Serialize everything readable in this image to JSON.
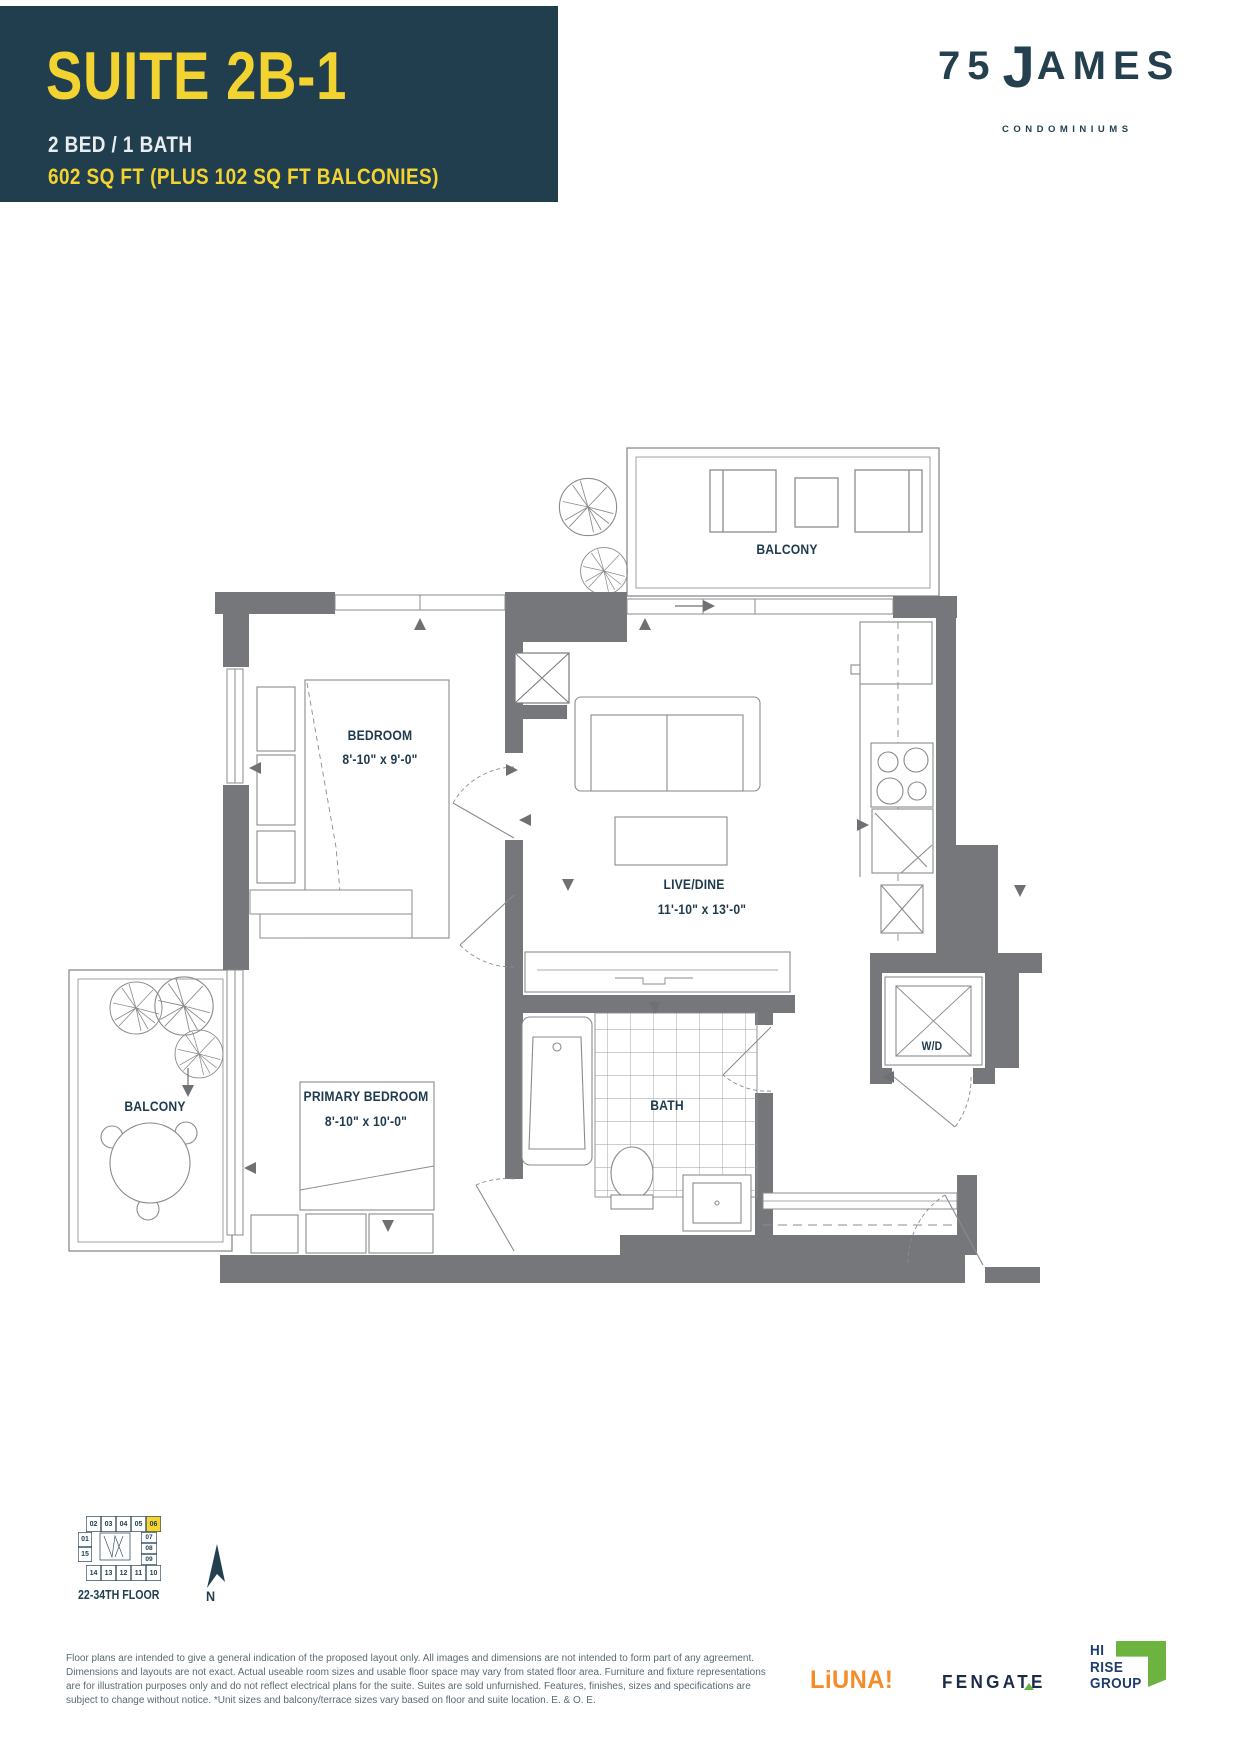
{
  "colors": {
    "header_bg": "#213e4e",
    "accent_yellow": "#f3d32f",
    "navy_text": "#1e3a4c",
    "wall_gray": "#76777a",
    "line_gray": "#8a8b8e",
    "keyplan_highlight": "#f5d42c",
    "liuna_orange": "#f68b28",
    "fengate_navy": "#1c2b49",
    "logo_green": "#6cb33f",
    "hirise_navy": "#1e3c6e",
    "disclaimer_gray": "#5a6a73"
  },
  "header": {
    "suite_title": "SUITE 2B-1",
    "bed_bath": "2 BED / 1 BATH",
    "area": "602 SQ FT (PLUS 102 SQ FT BALCONIES)"
  },
  "brand": {
    "number": "75",
    "j": "J",
    "rest": "AMES",
    "tagline": "CONDOMINIUMS"
  },
  "plan": {
    "balcony_top_label": "BALCONY",
    "bedroom_label": "BEDROOM",
    "bedroom_dims": "8'-10\" x 9'-0\"",
    "live_dine_label": "LIVE/DINE",
    "live_dine_dims": "11'-10\" x 13'-0\"",
    "bath_label": "BATH",
    "wd_label": "W/D",
    "primary_label": "PRIMARY BEDROOM",
    "primary_dims": "8'-10\" x 10'-0\"",
    "balcony_left_label": "BALCONY"
  },
  "keyplan": {
    "caption": "22-34TH FLOOR",
    "north": "N",
    "highlight": "06",
    "top": [
      "02",
      "03",
      "04",
      "05",
      "06"
    ],
    "left": [
      "01",
      "15"
    ],
    "right": [
      "07",
      "08",
      "09"
    ],
    "bottom": [
      "14",
      "13",
      "12",
      "11",
      "10"
    ]
  },
  "disclaimer": {
    "lines": [
      "Floor plans are intended to give a general indication of the proposed layout only. All images and dimensions are not intended to form part of any agreement.",
      "Dimensions and layouts are not exact. Actual useable room sizes and usable floor space may vary from stated floor area. Furniture and fixture representations",
      "are for illustration purposes only and do not reflect electrical plans for the suite. Suites are sold unfurnished. Features, finishes, sizes and specifications are",
      "subject to change without notice. *Unit sizes and balcony/terrace sizes vary based on floor and suite location. E. & O. E."
    ]
  },
  "partners": {
    "liuna": "LiUNA!",
    "fengate": "FENGATE",
    "hirise": [
      "HI",
      "RISE",
      "GROUP"
    ]
  }
}
